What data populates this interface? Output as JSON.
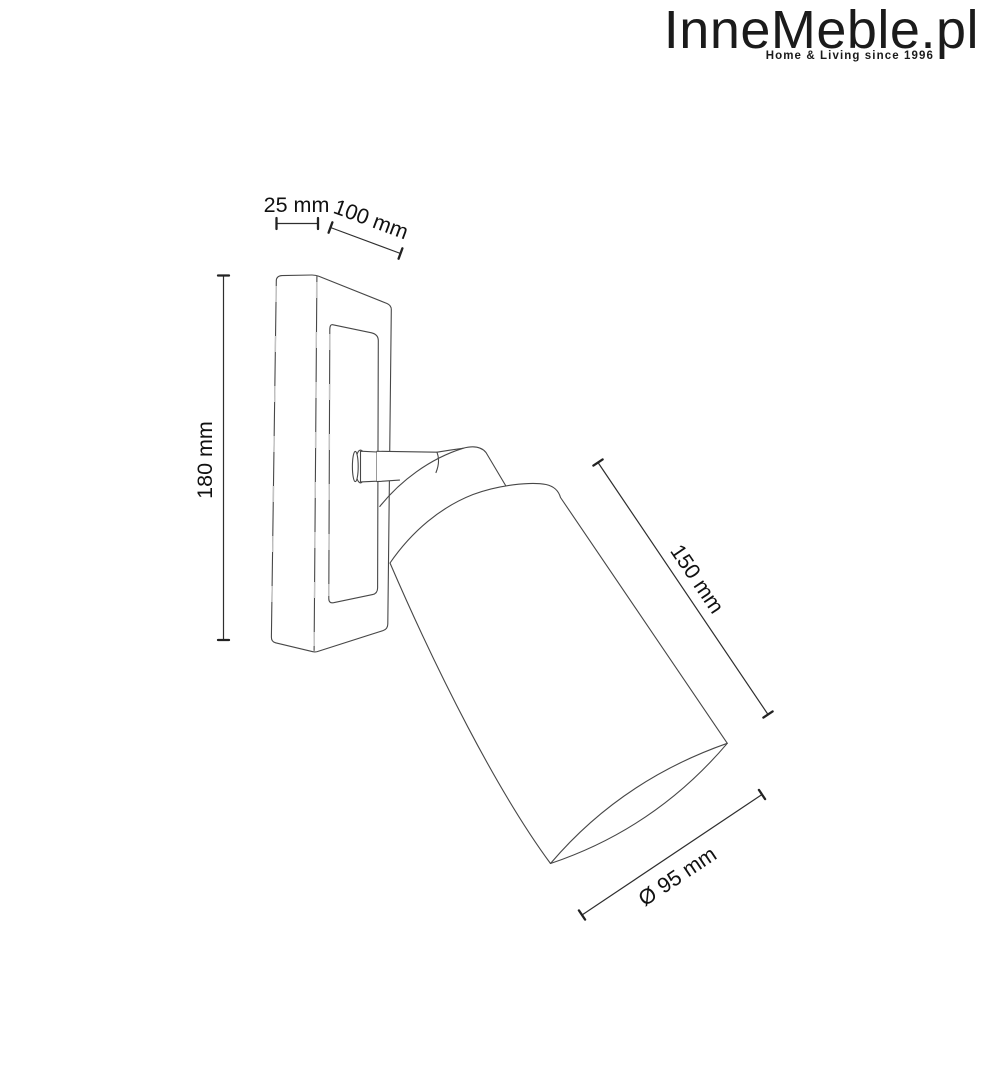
{
  "page": {
    "background": "#ffffff"
  },
  "logo": {
    "brand": "InneMeble.pl",
    "tagline": "Home & Living since 1996",
    "color": "#1b1b1b"
  },
  "drawing": {
    "kind": "product dimension diagram",
    "subject": "wall-mounted spot lamp with rectangular backplate, swivel joint arm and tilted cylindrical shade",
    "line_color": "#474747",
    "dimension_line_color": "#2e2e2e",
    "label_color": "#111111",
    "dimensions": [
      {
        "name": "backplate-depth",
        "label": "25 mm"
      },
      {
        "name": "backplate-width",
        "label": "100 mm"
      },
      {
        "name": "backplate-height",
        "label": "180 mm"
      },
      {
        "name": "shade-length",
        "label": "150 mm"
      },
      {
        "name": "shade-diameter",
        "label": "Ø 95 mm"
      }
    ]
  }
}
